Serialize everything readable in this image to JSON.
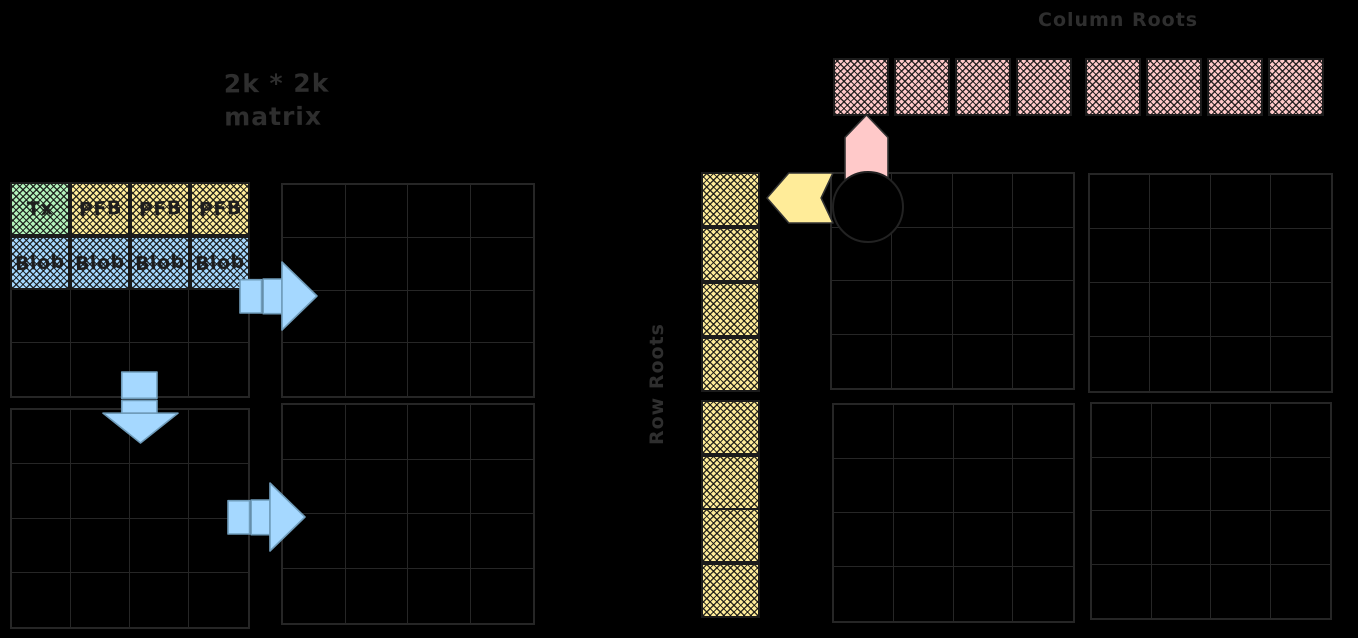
{
  "canvas": {
    "width": 1358,
    "height": 638,
    "background": "#000000"
  },
  "colors": {
    "stroke": "#262626",
    "text_dim": "#2e2e2e",
    "cell_text": "#1e1e1e",
    "green": "#b2f2bb",
    "yellow": "#ffec99",
    "blue": "#a5d8ff",
    "pink": "#ffc9c9",
    "arrow_blue": "#a5d8ff",
    "arrow_blue_outline": "#6f9cba"
  },
  "labels": {
    "matrix_title_line1": "2k * 2k",
    "matrix_title_line2": "matrix"
  },
  "left_matrix": {
    "grids": [
      {
        "x": 10,
        "y": 182,
        "w": 240,
        "h": 216,
        "rows": 4,
        "cols": 4
      },
      {
        "x": 281,
        "y": 183,
        "w": 254,
        "h": 215,
        "rows": 4,
        "cols": 4
      },
      {
        "x": 10,
        "y": 408,
        "w": 240,
        "h": 221,
        "rows": 4,
        "cols": 4
      },
      {
        "x": 281,
        "y": 403,
        "w": 254,
        "h": 222,
        "rows": 4,
        "cols": 4
      }
    ],
    "cells": [
      {
        "label": "Tx",
        "color": "green",
        "row": 0,
        "col": 0
      },
      {
        "label": "PFB",
        "color": "yellow",
        "row": 0,
        "col": 1
      },
      {
        "label": "PFB",
        "color": "yellow",
        "row": 0,
        "col": 2
      },
      {
        "label": "PFB",
        "color": "yellow",
        "row": 0,
        "col": 3
      },
      {
        "label": "Blob",
        "color": "blue",
        "row": 1,
        "col": 0
      },
      {
        "label": "Blob",
        "color": "blue",
        "row": 1,
        "col": 1
      },
      {
        "label": "Blob",
        "color": "blue",
        "row": 1,
        "col": 2
      },
      {
        "label": "Blob",
        "color": "blue",
        "row": 1,
        "col": 3
      }
    ]
  },
  "right_matrix": {
    "grids": [
      {
        "x": 830,
        "y": 172,
        "w": 245,
        "h": 218,
        "rows": 4,
        "cols": 4
      },
      {
        "x": 1088,
        "y": 173,
        "w": 245,
        "h": 220,
        "rows": 4,
        "cols": 4
      },
      {
        "x": 832,
        "y": 403,
        "w": 243,
        "h": 220,
        "rows": 4,
        "cols": 4
      },
      {
        "x": 1090,
        "y": 402,
        "w": 242,
        "h": 218,
        "rows": 4,
        "cols": 4
      }
    ]
  },
  "column_roots": {
    "label": "Column Roots",
    "square_y": 58,
    "square_w": 56,
    "square_h": 58,
    "square_xs": [
      833,
      894,
      955,
      1016,
      1085,
      1146,
      1207,
      1268
    ]
  },
  "row_roots": {
    "label": "Row Roots",
    "square_x": 701,
    "square_w": 59,
    "square_h": 55,
    "square_ys": [
      172,
      227,
      282,
      337,
      400,
      455,
      508,
      563
    ]
  },
  "arrows": [
    {
      "name": "flow-arrow-right-top",
      "type": "right",
      "x": 240,
      "y": 262,
      "w": 77,
      "h": 68,
      "color": "arrow_blue"
    },
    {
      "name": "flow-arrow-down",
      "type": "down",
      "x": 103,
      "y": 372,
      "w": 75,
      "h": 71,
      "color": "arrow_blue"
    },
    {
      "name": "flow-arrow-right-bottom",
      "type": "right",
      "x": 228,
      "y": 483,
      "w": 77,
      "h": 68,
      "color": "arrow_blue"
    },
    {
      "name": "pink-arrow-up",
      "type": "up-notched",
      "x": 845,
      "y": 115,
      "w": 43,
      "h": 80,
      "color": "pink"
    },
    {
      "name": "yellow-arrow-left",
      "type": "left-notched",
      "x": 767,
      "y": 173,
      "w": 66,
      "h": 50,
      "color": "yellow"
    }
  ],
  "black_dot": {
    "cx": 868,
    "cy": 207,
    "r": 36
  }
}
